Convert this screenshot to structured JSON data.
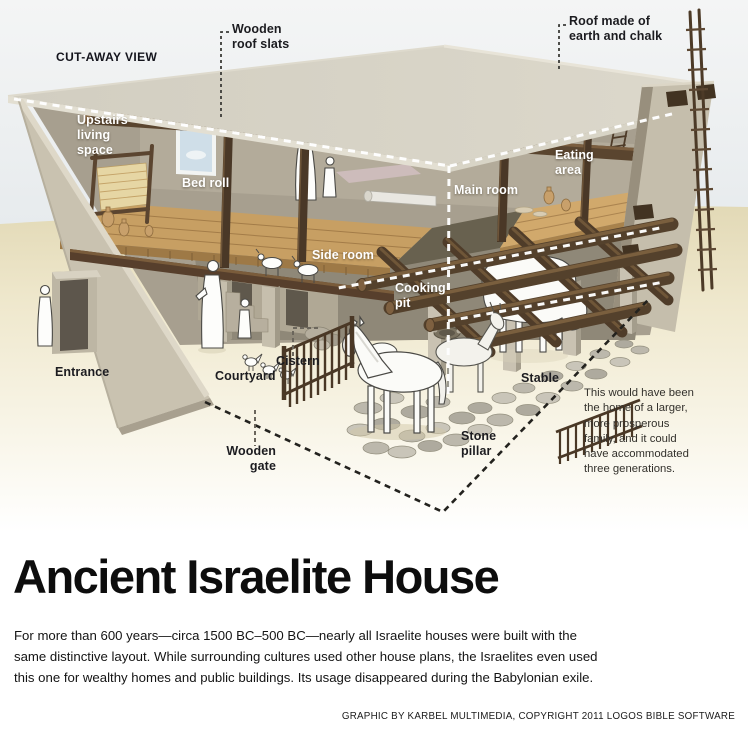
{
  "scene": {
    "view_label": "CUT-AWAY VIEW",
    "labels": {
      "wooden_roof_slats": "Wooden\nroof slats",
      "roof_material": "Roof made of\nearth and chalk",
      "upstairs_living_space": "Upstairs\nliving\nspace",
      "bed_roll": "Bed roll",
      "eating_area": "Eating\narea",
      "main_room": "Main room",
      "side_room": "Side room",
      "cooking_pit": "Cooking\npit",
      "cistern": "Cistern",
      "courtyard": "Courtyard",
      "entrance": "Entrance",
      "wooden_gate": "Wooden\ngate",
      "stable": "Stable",
      "stone_pillar": "Stone\npillar"
    },
    "note": "This would have been\nthe home of a larger,\nmore prosperous\nfamily, and it could\nhave accommodated\nthree generations."
  },
  "article": {
    "title": "Ancient Israelite House",
    "body": "For more than 600 years—circa 1500 BC–500 BC—nearly all Israelite houses were built with the\nsame distinctive layout. While surrounding cultures used other house plans, the Israelites even used\nthis one for wealthy homes and public buildings. Its usage disappeared during the Babylonian exile.",
    "credit": "GRAPHIC BY KARBEL MULTIMEDIA, COPYRIGHT 2011 LOGOS BIBLE SOFTWARE"
  },
  "colors": {
    "sky": "#dfe5ea",
    "sand": "#efe8cd",
    "wall": "#c8c1af",
    "roof": "#d6d2c5",
    "wood": "#5d4731",
    "label_dark": "#1c1c20",
    "label_light": "#ffffff"
  }
}
